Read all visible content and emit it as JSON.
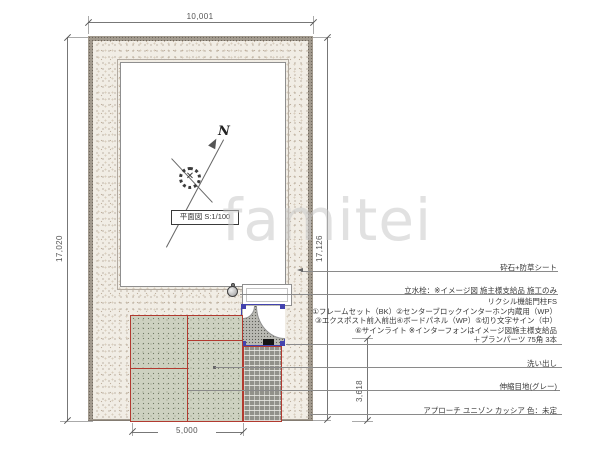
{
  "plan": {
    "title": "平面図 S:1/100",
    "north_label": "N",
    "watermark": "famitei"
  },
  "dimensions": {
    "site_width_top": "10,001",
    "site_height_left": "17,020",
    "site_height_right": "17,126",
    "approach_length": "3,618",
    "paving_width_bottom": "5,000"
  },
  "annotations": {
    "gravel": "砕石+防草シート",
    "water_tap": "立水栓：※イメージ図 施主様支給品 施工のみ",
    "gate_post": [
      "リクシル機能門柱FS",
      "①フレームセット（BK）②センターブロックインターホン内蔵用（WP）",
      "③エクスポスト前入前出④ボードパネル（WP）⑤切り文字サイン（中）",
      "⑥サインライト ※インターフォンはイメージ図施主様支給品",
      "＋プランパーツ 75角 3本"
    ],
    "washout": "洗い出し",
    "expansion_joint": "伸縮目地(グレー)",
    "approach": "アプローチ ユニゾン カッシア 色：未定"
  },
  "colors": {
    "joint_red": "#b23a30",
    "gate_blue": "#4343ae",
    "gravel_base": "#f1ede5",
    "washout_base": "#cdd1c0",
    "brick_base": "#91918a"
  },
  "icons": {
    "north_compass": "compass-rose",
    "water_tap": "tap-circle"
  }
}
